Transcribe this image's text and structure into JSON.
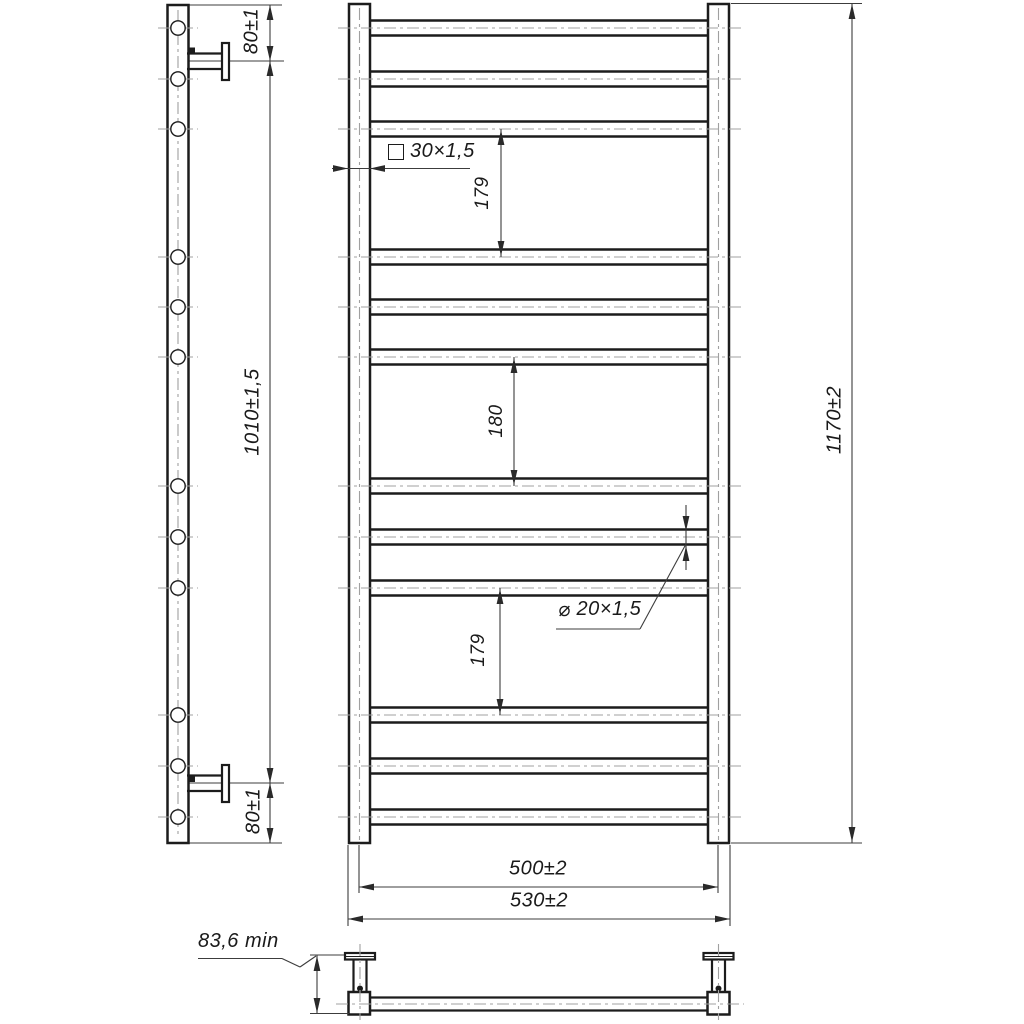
{
  "drawing": {
    "kind": "technical drawing",
    "subject": "ladder towel rail with wall brackets, three orthographic views",
    "background": "#ffffff",
    "line_colors": {
      "outline": "#1c1c1c",
      "dimension": "#3c3c3c",
      "centerline": "#a0a0a0"
    },
    "structure": {
      "rung_count": 12,
      "rung_groups": 4,
      "rungs_per_group": 3,
      "wall_brackets": 2
    }
  },
  "views": {
    "side": {
      "dims": {
        "top_bracket_offset": "80±1",
        "bracket_span": "1010±1,5",
        "bottom_bracket_offset": "80±1"
      }
    },
    "front": {
      "dims": {
        "group_gap_top": "179",
        "group_gap_middle": "180",
        "group_gap_bottom": "179",
        "overall_height": "1170±2",
        "mounting_width": "500±2",
        "overall_width": "530±2"
      },
      "callouts": {
        "post_profile": {
          "symbol": "square",
          "value": "30×1,5"
        },
        "rung_profile": {
          "symbol": "⌀",
          "value": "20×1,5"
        }
      }
    },
    "top": {
      "dims": {
        "wall_clearance": "83,6 min"
      }
    }
  }
}
